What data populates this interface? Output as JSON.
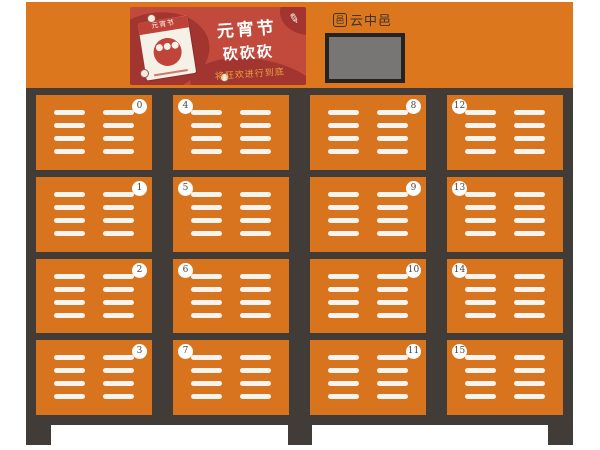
{
  "theme": {
    "header_orange": "#DC771D",
    "door_orange": "#D8731E",
    "frame_dark": "#423C38",
    "banner_red": "#C14A3D",
    "banner_red_dark": "#A23530",
    "gold": "#E8A33D",
    "screen_gray": "#787674",
    "screen_border": "#262220",
    "slat_white": "#F7F4F0",
    "badge_text": "#4A443E",
    "brand_text": "#3B332E"
  },
  "header": {
    "banner": {
      "title_line1": "元宵节",
      "title_line2": "砍砍砍",
      "subtitle": "将狂欢进行到底",
      "calendar_label": "元宵节",
      "brush_glyph": "✎"
    },
    "brand": {
      "name": "云中邑",
      "icon_glyph": "邑"
    }
  },
  "lockers": {
    "doors": [
      {
        "number": "0",
        "badge": "right"
      },
      {
        "number": "1",
        "badge": "right"
      },
      {
        "number": "2",
        "badge": "right"
      },
      {
        "number": "3",
        "badge": "right"
      },
      {
        "number": "4",
        "badge": "left"
      },
      {
        "number": "5",
        "badge": "left"
      },
      {
        "number": "6",
        "badge": "left"
      },
      {
        "number": "7",
        "badge": "left"
      },
      {
        "number": "8",
        "badge": "right"
      },
      {
        "number": "9",
        "badge": "right"
      },
      {
        "number": "10",
        "badge": "right"
      },
      {
        "number": "11",
        "badge": "right"
      },
      {
        "number": "12",
        "badge": "left"
      },
      {
        "number": "13",
        "badge": "left"
      },
      {
        "number": "14",
        "badge": "left"
      },
      {
        "number": "15",
        "badge": "left"
      }
    ]
  }
}
